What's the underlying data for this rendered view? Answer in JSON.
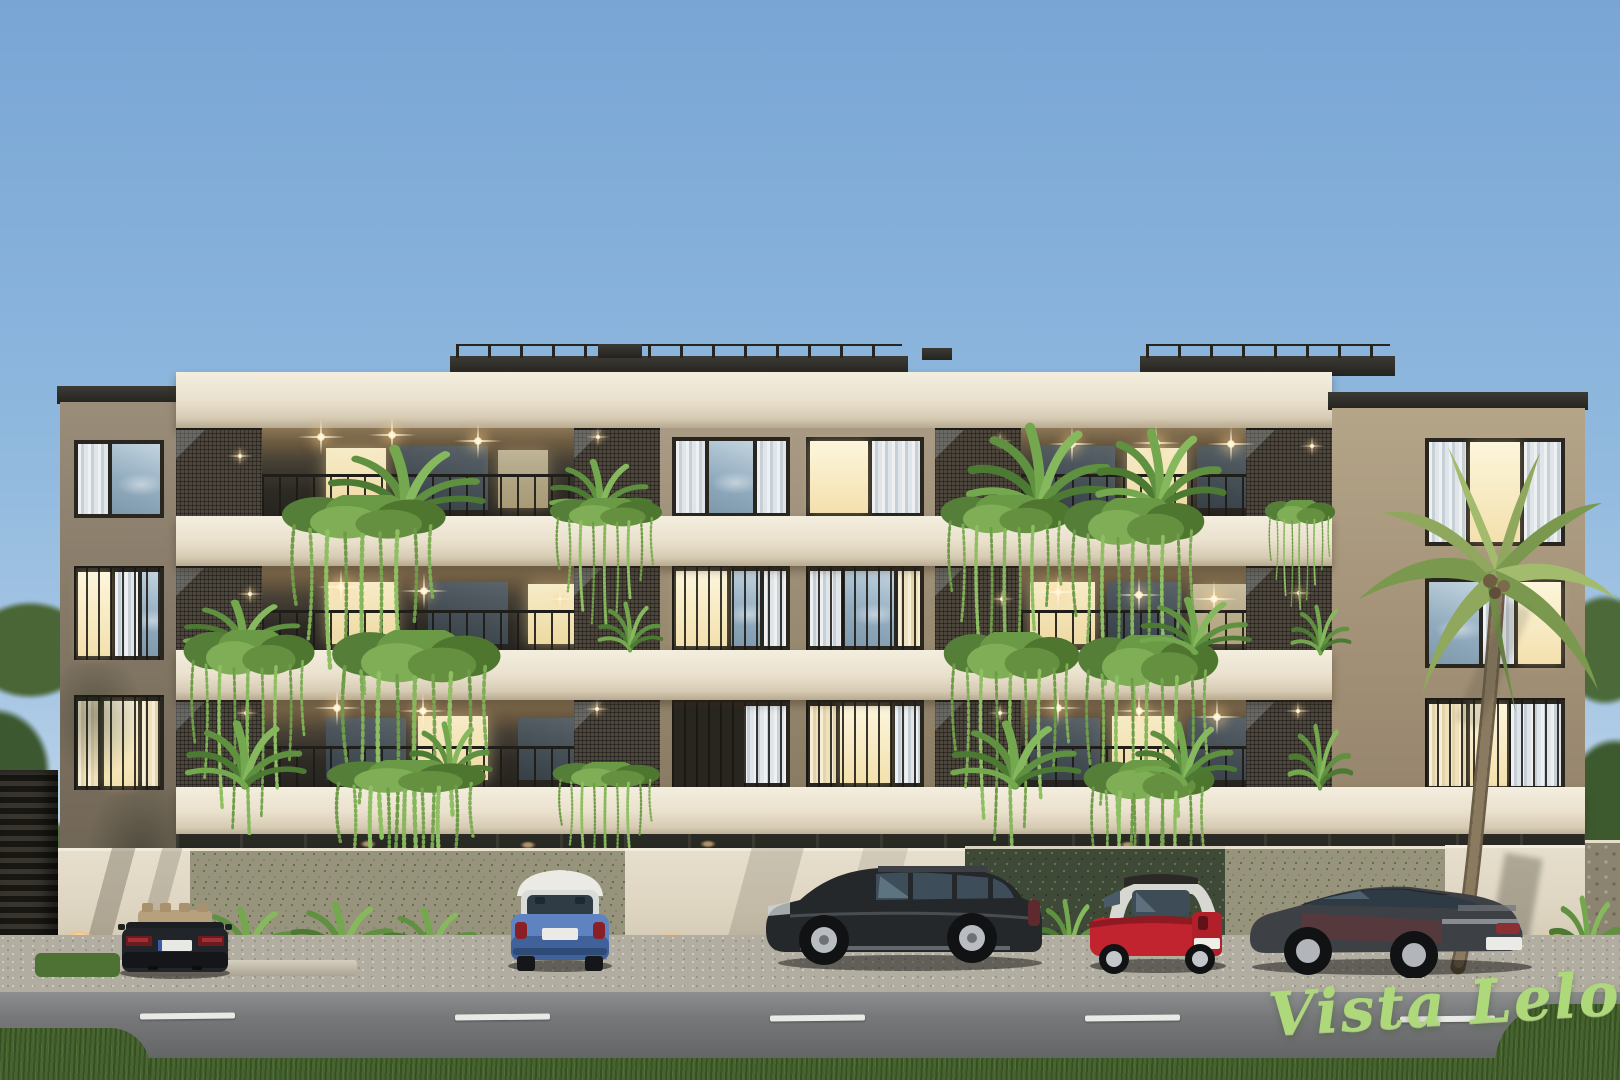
{
  "image": {
    "title": "Vista Leloir — apartment building exterior render at dusk"
  },
  "watermark": {
    "text": "Vista Leloir",
    "color": "#aed97a"
  },
  "scene": {
    "sky": {
      "top": "#79a5d5",
      "bottom": "#d9e7ef"
    },
    "building": {
      "floors_visible": 4,
      "slab_color": "#eae1cd",
      "facade_color": "#a3947d",
      "window_frame_color": "#29261f",
      "balcony_soffit_color": "#8a7656",
      "mesh_panel_color": "#4c463c",
      "lit_window_color": "#f3e0ad",
      "balcony_light_color": "#ffe9b8"
    },
    "landscaping": {
      "hanging_plant_color": "#86b75c",
      "shrub_color": "#5f9140",
      "palm_tree": true
    },
    "perimeter_wall": {
      "plain_color": "#dcd3bf",
      "vine_color": "#98937c",
      "ivy_color": "#3e4937"
    },
    "vehicles": [
      {
        "name": "dark-convertible",
        "body_color": "#1e2124",
        "interior_color": "#c0ab84"
      },
      {
        "name": "blue-hatchback-white-roof",
        "body_color": "#5f83c0",
        "roof_color": "#eceae4"
      },
      {
        "name": "black-suv",
        "body_color": "#26282b"
      },
      {
        "name": "red-microcar-silver-frame",
        "body_color": "#c1242e",
        "frame_color": "#d8d8d2"
      },
      {
        "name": "grey-sedan",
        "body_color": "#383b3f"
      }
    ],
    "road": {
      "asphalt_color": "#77787a",
      "marking_color": "#e9e9e5"
    },
    "grass_color": "#47632f",
    "gravel_color": "#b2ada1"
  }
}
